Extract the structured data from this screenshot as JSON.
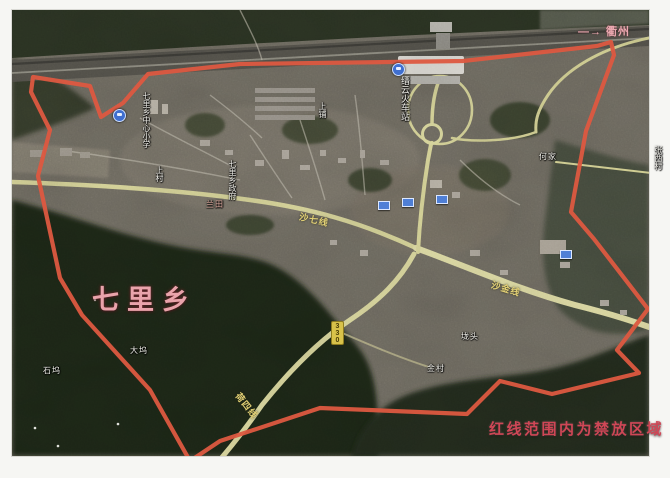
{
  "map": {
    "region_label": "七里乡",
    "restriction_note": "红线范围内为禁放区域",
    "direction_note": "—→ 衢州",
    "boundary": {
      "color": "#dd5940",
      "points": "190,461 150,390 82,315 60,278 38,176 50,130 31,92 33,77 90,86 101,117 123,103 148,74 240,64 463,61 597,46 611,42 614,55 586,131 571,212 594,239 648,309 617,350 639,373 552,394 500,381 467,414 320,408 220,441 193,459"
    },
    "place_labels": [
      {
        "text": "缙云火车站"
      },
      {
        "text": "七里乡中心小学"
      },
      {
        "text": "上村"
      },
      {
        "text": "七里乡政府"
      },
      {
        "text": "上铺"
      },
      {
        "text": "兰田"
      },
      {
        "text": "何家"
      },
      {
        "text": "张西村"
      },
      {
        "text": "垅头"
      },
      {
        "text": "金村"
      },
      {
        "text": "大坞"
      },
      {
        "text": "石坞"
      }
    ],
    "road_labels": [
      {
        "text": "沙七线"
      },
      {
        "text": "沙金线"
      },
      {
        "text": "荷四线"
      },
      {
        "text": "330"
      }
    ]
  }
}
